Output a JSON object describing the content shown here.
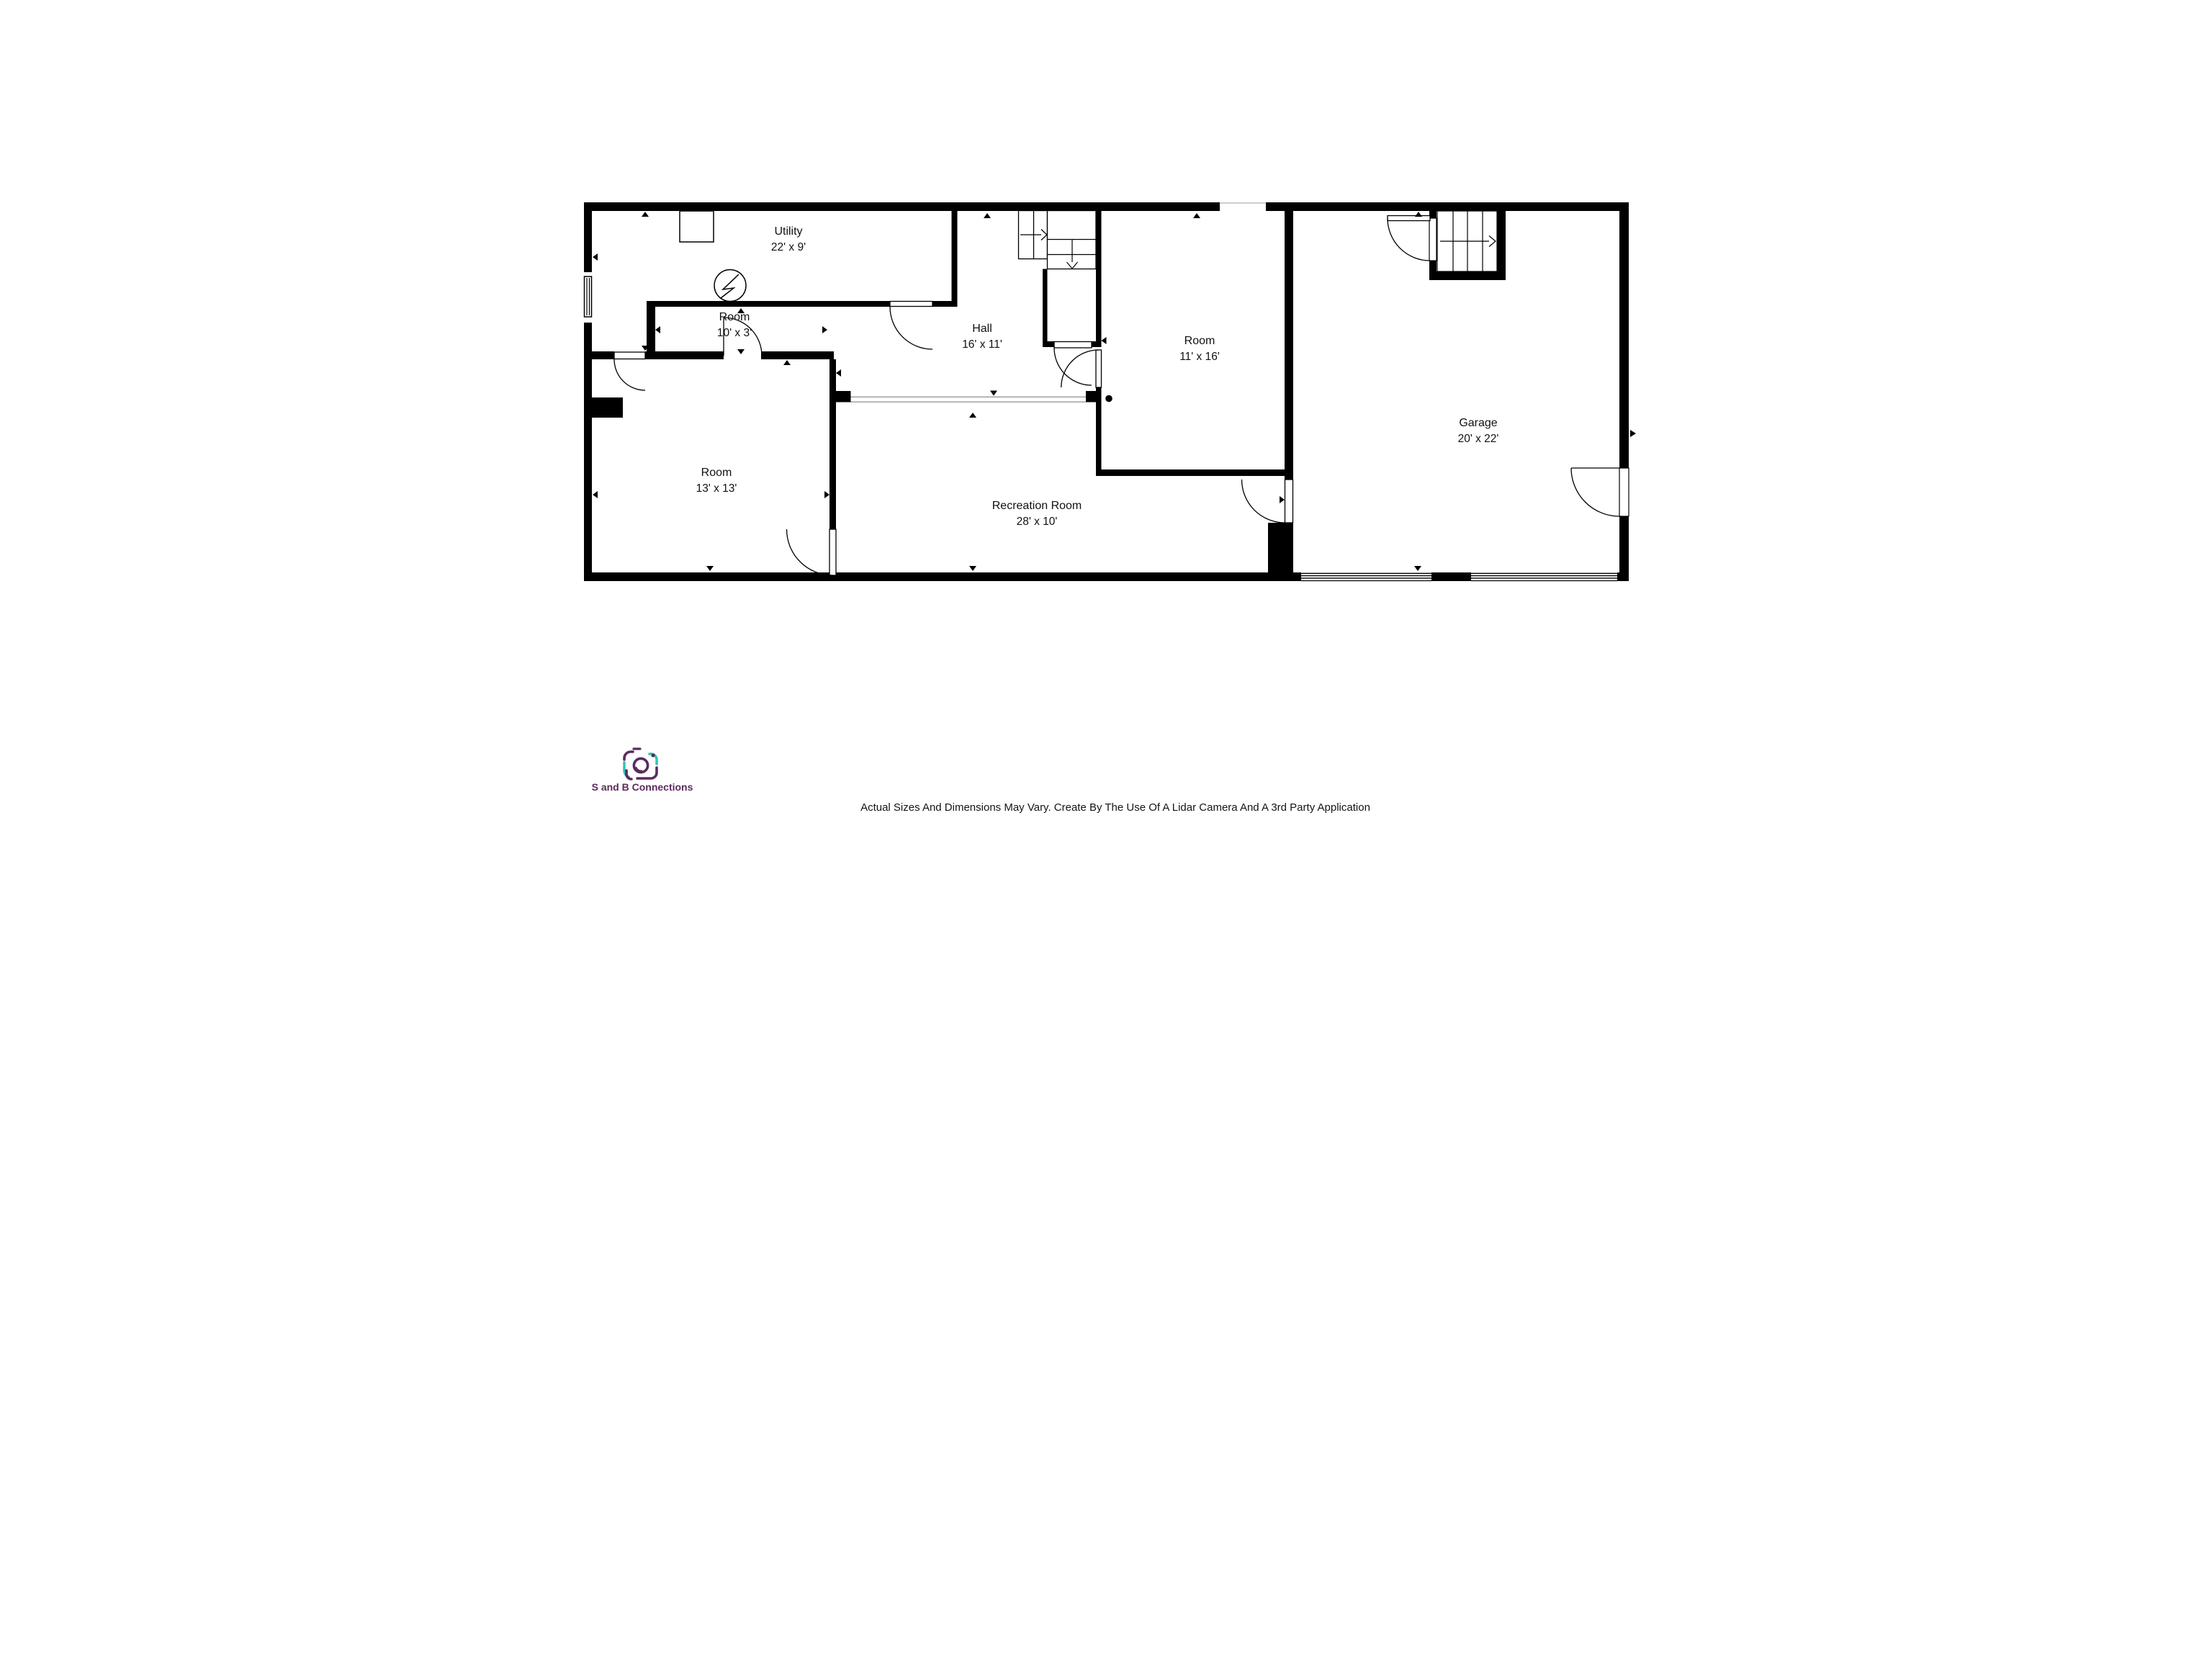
{
  "plan": {
    "type": "basement-floor-plan",
    "rooms": [
      {
        "id": "utility",
        "name": "Utility",
        "dims": "22' x 9'"
      },
      {
        "id": "closet",
        "name": "Room",
        "dims": "10' x 3'"
      },
      {
        "id": "hall",
        "name": "Hall",
        "dims": "16' x 11'"
      },
      {
        "id": "room-ne",
        "name": "Room",
        "dims": "11' x 16'"
      },
      {
        "id": "room-sw",
        "name": "Room",
        "dims": "13' x 13'"
      },
      {
        "id": "recreation",
        "name": "Recreation Room",
        "dims": "28' x 10'"
      },
      {
        "id": "garage",
        "name": "Garage",
        "dims": "20' x 22'"
      }
    ],
    "symbols": [
      {
        "icon": "electrical-meter-icon",
        "desc": "circle with lightning bolt on closet wall"
      },
      {
        "icon": "support-column-dot",
        "desc": "round steel post at end of recreation room opening"
      },
      {
        "icon": "stair-up-arrow",
        "desc": "open arrows on both stair runs"
      },
      {
        "icon": "compass-tick-markers",
        "desc": "small black triangles along walls"
      }
    ],
    "colors": {
      "walls": "#000000",
      "floor": "#ffffff",
      "opening-line": "#999999"
    }
  },
  "branding": {
    "company": "S and B Connections",
    "logo_icon": "camera-icon",
    "colors": {
      "purple": "#5b2b5e",
      "teal": "#35c4b5"
    }
  },
  "disclaimer": "Actual Sizes And Dimensions May Vary. Create By The Use Of A Lidar Camera And A 3rd Party Application"
}
